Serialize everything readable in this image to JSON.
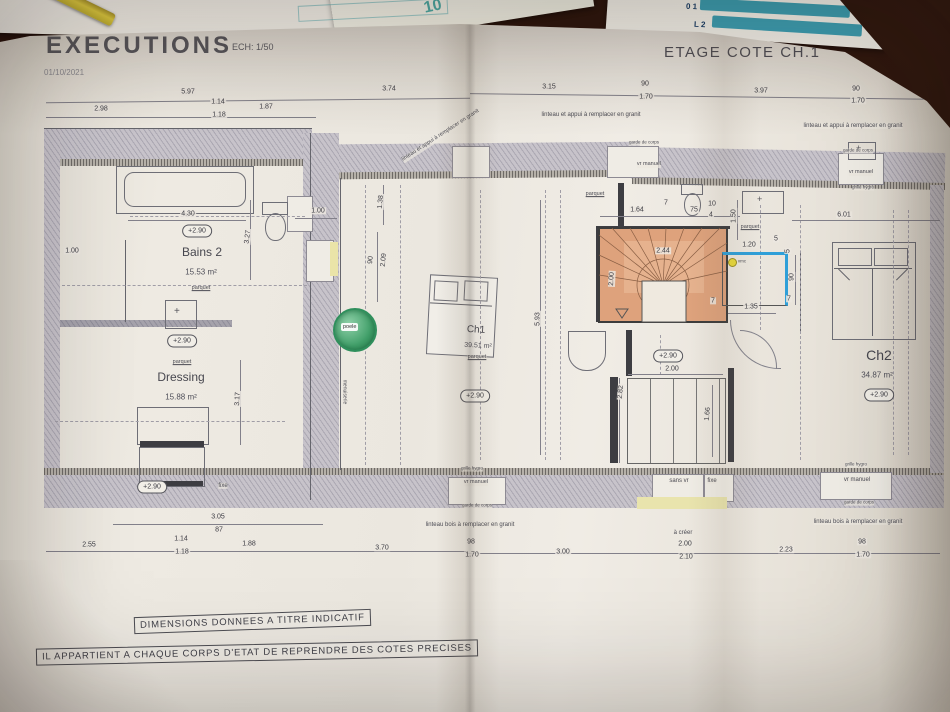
{
  "header": {
    "title": "EXECUTIONS",
    "scale_label": "ECH: 1/50",
    "date": "01/10/2021",
    "sheet_title": "ETAGE COTE CH.1"
  },
  "rooms": {
    "bains2": {
      "name": "Bains 2",
      "area": "15.53 m²",
      "level": "+2.90"
    },
    "dressing": {
      "name": "Dressing",
      "area": "15.88 m²",
      "level": "+2.90"
    },
    "ch1": {
      "name": "Ch1",
      "area": "39.51 m²",
      "level": "+2.90"
    },
    "ch2": {
      "name": "Ch2",
      "area": "34.87 m²",
      "level": "+2.90"
    },
    "landing": {
      "level": "+2.90"
    }
  },
  "stamp": {
    "text": "poele"
  },
  "notes": {
    "line1": "DIMENSIONS DONNEES A TITRE INDICATIF",
    "line2": "IL APPARTIENT A CHAQUE CORPS D'ETAT DE REPRENDRE DES COTES PRECISES"
  },
  "top_papers": {
    "teal_number": "10",
    "rows": [
      "0 1",
      "L 2",
      "M 3"
    ]
  },
  "colors": {
    "stair_wood": "#dea27c",
    "stamp_green": "#3f9e68",
    "highlight_blue": "#2f9fd8",
    "teal": "#3d9db0",
    "paper": "#ebe7df"
  },
  "dim_labels": [
    {
      "t": "5.97",
      "x": 188,
      "y": 92
    },
    {
      "t": "3.74",
      "x": 389,
      "y": 89
    },
    {
      "t": "3.15",
      "x": 549,
      "y": 87
    },
    {
      "t": "90",
      "x": 645,
      "y": 84
    },
    {
      "t": "1.70",
      "x": 646,
      "y": 97
    },
    {
      "t": "3.97",
      "x": 761,
      "y": 91
    },
    {
      "t": "90",
      "x": 856,
      "y": 89
    },
    {
      "t": "1.70",
      "x": 858,
      "y": 101
    },
    {
      "t": "2.98",
      "x": 101,
      "y": 109
    },
    {
      "t": "1.14",
      "x": 218,
      "y": 102
    },
    {
      "t": "1.18",
      "x": 219,
      "y": 115
    },
    {
      "t": "1.87",
      "x": 266,
      "y": 107
    },
    {
      "t": "4.30",
      "x": 188,
      "y": 214
    },
    {
      "t": "1.00",
      "x": 318,
      "y": 211
    },
    {
      "t": "1.00",
      "x": 72,
      "y": 251
    },
    {
      "t": "3.27",
      "x": 248,
      "y": 237,
      "r": -83
    },
    {
      "t": "1.38",
      "x": 381,
      "y": 202,
      "r": -85
    },
    {
      "t": "90",
      "x": 371,
      "y": 260,
      "r": -85
    },
    {
      "t": "2.09",
      "x": 384,
      "y": 260,
      "r": -85
    },
    {
      "t": "3.17",
      "x": 238,
      "y": 399,
      "r": -87
    },
    {
      "t": "5.93",
      "x": 538,
      "y": 319,
      "r": -90
    },
    {
      "t": "1.64",
      "x": 637,
      "y": 210
    },
    {
      "t": "7",
      "x": 666,
      "y": 203
    },
    {
      "t": "75",
      "x": 694,
      "y": 210
    },
    {
      "t": "10",
      "x": 712,
      "y": 204
    },
    {
      "t": "4",
      "x": 711,
      "y": 215
    },
    {
      "t": "1.50",
      "x": 734,
      "y": 216,
      "r": -90
    },
    {
      "t": "1.20",
      "x": 749,
      "y": 245
    },
    {
      "t": "5",
      "x": 776,
      "y": 239
    },
    {
      "t": "5",
      "x": 788,
      "y": 251,
      "r": -90
    },
    {
      "t": "90",
      "x": 792,
      "y": 277,
      "r": -90
    },
    {
      "t": "7",
      "x": 789,
      "y": 299
    },
    {
      "t": "1.35",
      "x": 751,
      "y": 307
    },
    {
      "t": "7",
      "x": 713,
      "y": 301
    },
    {
      "t": "2.44",
      "x": 663,
      "y": 251
    },
    {
      "t": "2.00",
      "x": 612,
      "y": 279,
      "r": -87
    },
    {
      "t": "6.01",
      "x": 844,
      "y": 215
    },
    {
      "t": "2.82",
      "x": 621,
      "y": 392,
      "r": -85
    },
    {
      "t": "1.66",
      "x": 708,
      "y": 414,
      "r": -85
    },
    {
      "t": "2.00",
      "x": 672,
      "y": 369
    },
    {
      "t": "3.05",
      "x": 218,
      "y": 517
    },
    {
      "t": "87",
      "x": 219,
      "y": 530
    },
    {
      "t": "2.55",
      "x": 89,
      "y": 545
    },
    {
      "t": "1.14",
      "x": 181,
      "y": 539
    },
    {
      "t": "1.18",
      "x": 182,
      "y": 552
    },
    {
      "t": "1.88",
      "x": 249,
      "y": 544
    },
    {
      "t": "3.70",
      "x": 382,
      "y": 548
    },
    {
      "t": "98",
      "x": 471,
      "y": 542
    },
    {
      "t": "1.70",
      "x": 472,
      "y": 555
    },
    {
      "t": "3.00",
      "x": 563,
      "y": 552
    },
    {
      "t": "2.00",
      "x": 685,
      "y": 544
    },
    {
      "t": "2.10",
      "x": 686,
      "y": 557
    },
    {
      "t": "2.23",
      "x": 786,
      "y": 550
    },
    {
      "t": "98",
      "x": 862,
      "y": 542
    },
    {
      "t": "1.70",
      "x": 863,
      "y": 555
    }
  ],
  "annotations": [
    {
      "t": "linteau et appui à remplacer en granit",
      "x": 591,
      "y": 115,
      "s": 6
    },
    {
      "t": "linteau et appui à remplacer en granit",
      "x": 853,
      "y": 126,
      "s": 6
    },
    {
      "t": "linteau et appui à remplacer en granit",
      "x": 441,
      "y": 136,
      "s": 5.5,
      "r": -33
    },
    {
      "t": "linteau bois à remplacer en granit",
      "x": 470,
      "y": 525,
      "s": 6
    },
    {
      "t": "linteau bois à remplacer en granit",
      "x": 858,
      "y": 522,
      "s": 6
    },
    {
      "t": "à créer",
      "x": 683,
      "y": 533,
      "s": 6
    },
    {
      "t": "garde de corps",
      "x": 644,
      "y": 143,
      "s": 4.5
    },
    {
      "t": "vr manuel",
      "x": 649,
      "y": 165,
      "s": 5.5
    },
    {
      "t": "garde de corps",
      "x": 858,
      "y": 151,
      "s": 4.5
    },
    {
      "t": "vr manuel",
      "x": 861,
      "y": 173,
      "s": 5.5
    },
    {
      "t": "grille hygro",
      "x": 863,
      "y": 188,
      "s": 4.5
    },
    {
      "t": "grille hygro",
      "x": 472,
      "y": 469,
      "s": 4.5
    },
    {
      "t": "vr manuel",
      "x": 476,
      "y": 483,
      "s": 5.5
    },
    {
      "t": "garde de corps",
      "x": 477,
      "y": 506,
      "s": 4.5
    },
    {
      "t": "sans vr",
      "x": 679,
      "y": 481,
      "s": 6
    },
    {
      "t": "fixe",
      "x": 712,
      "y": 481,
      "s": 6
    },
    {
      "t": "grille hygro",
      "x": 856,
      "y": 465,
      "s": 4.5
    },
    {
      "t": "vr manuel",
      "x": 857,
      "y": 480,
      "s": 6
    },
    {
      "t": "garde de corps",
      "x": 859,
      "y": 503,
      "s": 4.5
    },
    {
      "t": "fixe",
      "x": 223,
      "y": 486,
      "s": 6
    },
    {
      "t": "parquet",
      "x": 201,
      "y": 289,
      "s": 5.5,
      "u": 1
    },
    {
      "t": "parquet",
      "x": 182,
      "y": 363,
      "s": 5.5,
      "u": 1
    },
    {
      "t": "parquet",
      "x": 477,
      "y": 358,
      "s": 5.5,
      "u": 1
    },
    {
      "t": "parquet",
      "x": 595,
      "y": 195,
      "s": 5.5,
      "u": 1
    },
    {
      "t": "parquet",
      "x": 750,
      "y": 228,
      "s": 5.5,
      "u": 1
    },
    {
      "t": "menuiserie",
      "x": 344,
      "y": 392,
      "s": 5,
      "r": 90
    },
    {
      "t": "vmc",
      "x": 742,
      "y": 262,
      "s": 4.5
    }
  ]
}
